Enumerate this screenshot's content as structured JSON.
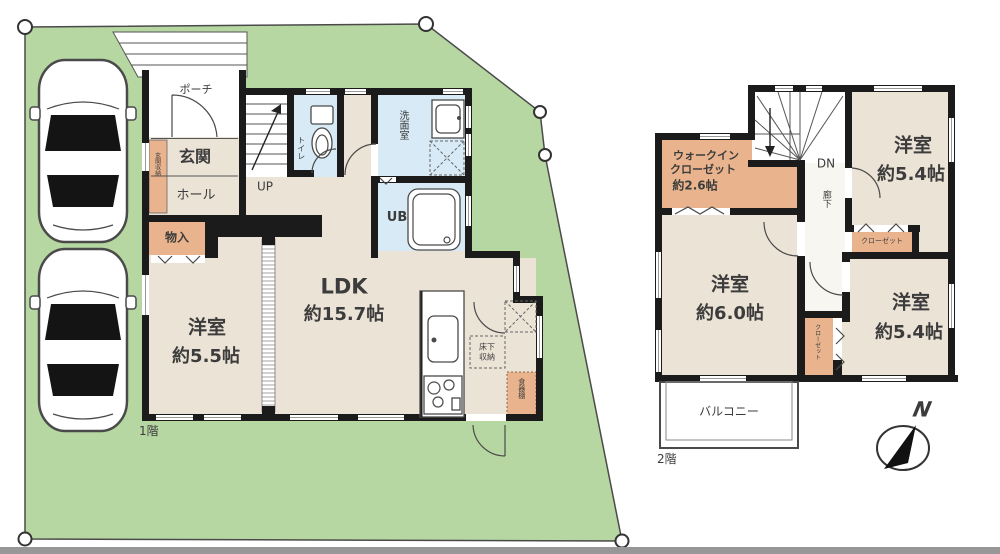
{
  "colors": {
    "lot_green": "#b7d7a2",
    "floor_beige": "#ece3d7",
    "wet_blue": "#d7eaf5",
    "closet_orange": "#e9b48d",
    "wall_black": "#1b1b1b",
    "hall_white": "#f8f6f0",
    "text_gray": "#3c3c3c",
    "outline_gray": "#4a4a4a",
    "bottom_bar": "#979797"
  },
  "floor1": {
    "label": "1階",
    "porch": "ポーチ",
    "entrance": "玄関",
    "hall": "ホール",
    "entrance_storage": "玄関収納",
    "stairs": "UP",
    "toilet": "トイレ",
    "washroom": "洗面室",
    "bath": "UB",
    "storage": "物入",
    "ldk_name": "LDK",
    "ldk_size": "約15.7帖",
    "bedroom_name": "洋室",
    "bedroom_size": "約5.5帖",
    "underfloor": "床下収納",
    "cupboard": "食器棚"
  },
  "floor2": {
    "label": "2階",
    "wic_line1": "ウォークイン",
    "wic_line2": "クローゼット",
    "wic_size": "約2.6帖",
    "stairs": "DN",
    "corridor": "廊下",
    "bedroom_ne_name": "洋室",
    "bedroom_ne_size": "約5.4帖",
    "closet_ne": "クローゼット",
    "bedroom_w_name": "洋室",
    "bedroom_w_size": "約6.0帖",
    "closet_mid": "クローゼット",
    "bedroom_se_name": "洋室",
    "bedroom_se_size": "約5.4帖",
    "balcony": "バルコニー"
  },
  "compass": {
    "north": "N"
  }
}
